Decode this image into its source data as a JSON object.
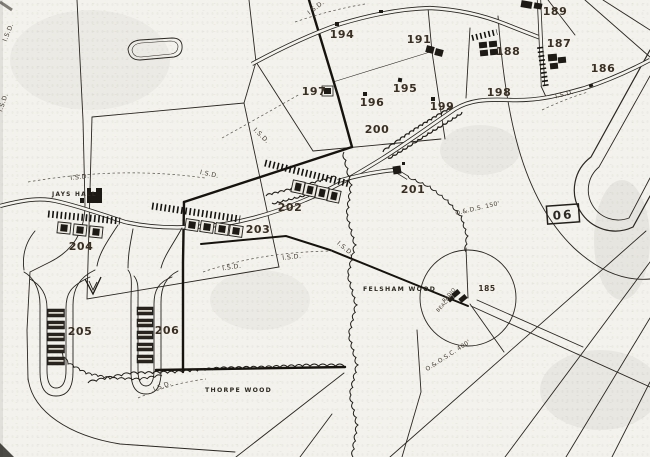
{
  "map": {
    "site_numbers": [
      {
        "label": "185",
        "x": 487,
        "y": 291,
        "size": 7.5
      },
      {
        "label": "186",
        "x": 603,
        "y": 72
      },
      {
        "label": "187",
        "x": 559,
        "y": 47
      },
      {
        "label": "188",
        "x": 508,
        "y": 55
      },
      {
        "label": "189",
        "x": 555,
        "y": 15
      },
      {
        "label": "191",
        "x": 419,
        "y": 43
      },
      {
        "label": "194",
        "x": 342,
        "y": 38
      },
      {
        "label": "195",
        "x": 405,
        "y": 92
      },
      {
        "label": "196",
        "x": 372,
        "y": 106
      },
      {
        "label": "197",
        "x": 314,
        "y": 95
      },
      {
        "label": "198",
        "x": 499,
        "y": 96
      },
      {
        "label": "199",
        "x": 442,
        "y": 110
      },
      {
        "label": "200",
        "x": 377,
        "y": 133
      },
      {
        "label": "201",
        "x": 413,
        "y": 193
      },
      {
        "label": "202",
        "x": 290,
        "y": 211
      },
      {
        "label": "203",
        "x": 258,
        "y": 233
      },
      {
        "label": "204",
        "x": 81,
        "y": 250
      },
      {
        "label": "205",
        "x": 80,
        "y": 335
      },
      {
        "label": "206",
        "x": 167,
        "y": 334
      }
    ],
    "place_names": [
      {
        "text": "JAYS HALL",
        "x": 52,
        "y": 196
      },
      {
        "text": "FELSHAM WOOD",
        "x": 363,
        "y": 291
      },
      {
        "text": "THORPE WOOD",
        "x": 205,
        "y": 392
      }
    ],
    "annotations": [
      {
        "text": "I.S.D.",
        "x": 317,
        "y": 9,
        "rotate": -38
      },
      {
        "text": "I.S.D.",
        "x": 10,
        "y": 33,
        "rotate": -68
      },
      {
        "text": "I.S.D.",
        "x": 5,
        "y": 103,
        "rotate": -72
      },
      {
        "text": "I.S.D.",
        "x": 260,
        "y": 137,
        "rotate": 44
      },
      {
        "text": "I.S.D.",
        "x": 80,
        "y": 179,
        "rotate": -6
      },
      {
        "text": "I.S.D.",
        "x": 209,
        "y": 176,
        "rotate": 12
      },
      {
        "text": "I.S.D.",
        "x": 565,
        "y": 96,
        "rotate": -14
      },
      {
        "text": "I.S.D.",
        "x": 232,
        "y": 269,
        "rotate": -8
      },
      {
        "text": "I.S.D.",
        "x": 292,
        "y": 259,
        "rotate": -6
      },
      {
        "text": "I.S.D.",
        "x": 344,
        "y": 250,
        "rotate": 40
      },
      {
        "text": "I.S.D.",
        "x": 163,
        "y": 388,
        "rotate": -20
      },
      {
        "text": "O.&.D.S. 150'",
        "x": 478,
        "y": 210,
        "rotate": -13,
        "size": 6
      },
      {
        "text": "O.&.O.S.C. 400'",
        "x": 449,
        "y": 357,
        "rotate": -33,
        "size": 6
      },
      {
        "text": "RADIO",
        "x": 450,
        "y": 296,
        "rotate": -48,
        "size": 4.8
      },
      {
        "text": "BEACON",
        "x": 446,
        "y": 304,
        "rotate": -48,
        "size": 4.8
      }
    ],
    "runway_marker": {
      "text": "06"
    }
  }
}
